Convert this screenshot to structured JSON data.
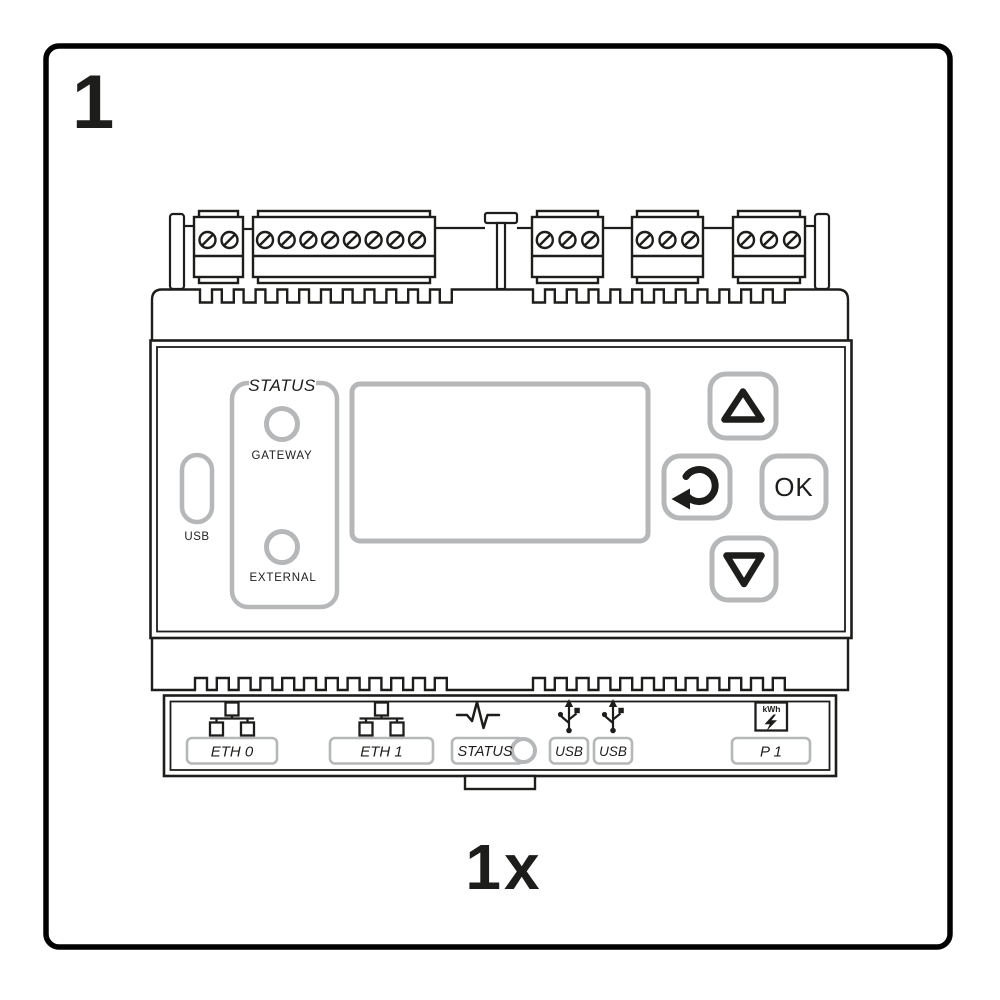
{
  "panel_card": {
    "step_number": "1",
    "quantity": "1x"
  },
  "device": {
    "front": {
      "usb_port_label": "USB",
      "status_section_title": "STATUS",
      "led_gateway_label": "GATEWAY",
      "led_external_label": "EXTERNAL",
      "ok_button_label": "OK",
      "buttons": [
        {
          "icon": "triangle-up"
        },
        {
          "icon": "return-arrow"
        },
        {
          "label": "OK"
        },
        {
          "icon": "triangle-down"
        }
      ]
    },
    "bottom_panel": {
      "ports": [
        {
          "icon": "ethernet-nodes",
          "label": "ETH 0"
        },
        {
          "icon": "ethernet-nodes",
          "label": "ETH 1"
        },
        {
          "icon": "heartbeat-line",
          "label": "STATUS"
        },
        {
          "icon": "usb-trident",
          "label": "USB"
        },
        {
          "icon": "usb-trident",
          "label": "USB"
        },
        {
          "icon": "kwh-lightning",
          "label": "P 1"
        }
      ],
      "kwh_icon_text": "kWh"
    },
    "colors": {
      "outline": "#1d1d1b",
      "muted_gray": "#b5b7b8",
      "background": "#ffffff"
    }
  }
}
